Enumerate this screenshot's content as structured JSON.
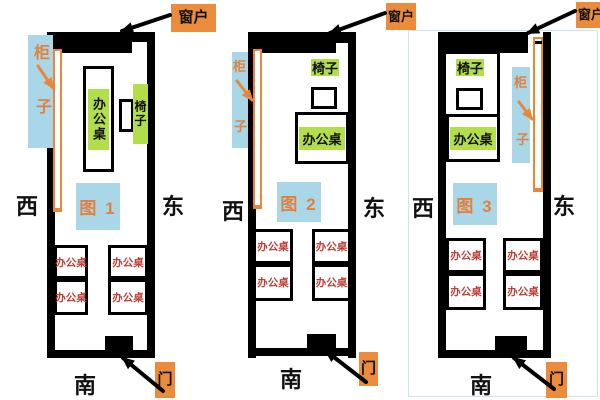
{
  "colors": {
    "label_bg": "#EA8C3C",
    "orange_ink": "#E0813F",
    "light_blue": "#A9D7E8",
    "green_highlight": "#B2DE4A",
    "desk_red": "#C03C34",
    "wall": "#000000"
  },
  "shared": {
    "window": "窗户",
    "door": "门",
    "cabinet": "柜子",
    "cabinet_top_char": "柜",
    "cabinet_bottom_char": "子",
    "chair": "椅子",
    "desk": "办公桌",
    "west": "西",
    "east": "东",
    "south": "南"
  },
  "panels": [
    {
      "figure": "图 1"
    },
    {
      "figure": "图 2"
    },
    {
      "figure": "图 3"
    }
  ]
}
